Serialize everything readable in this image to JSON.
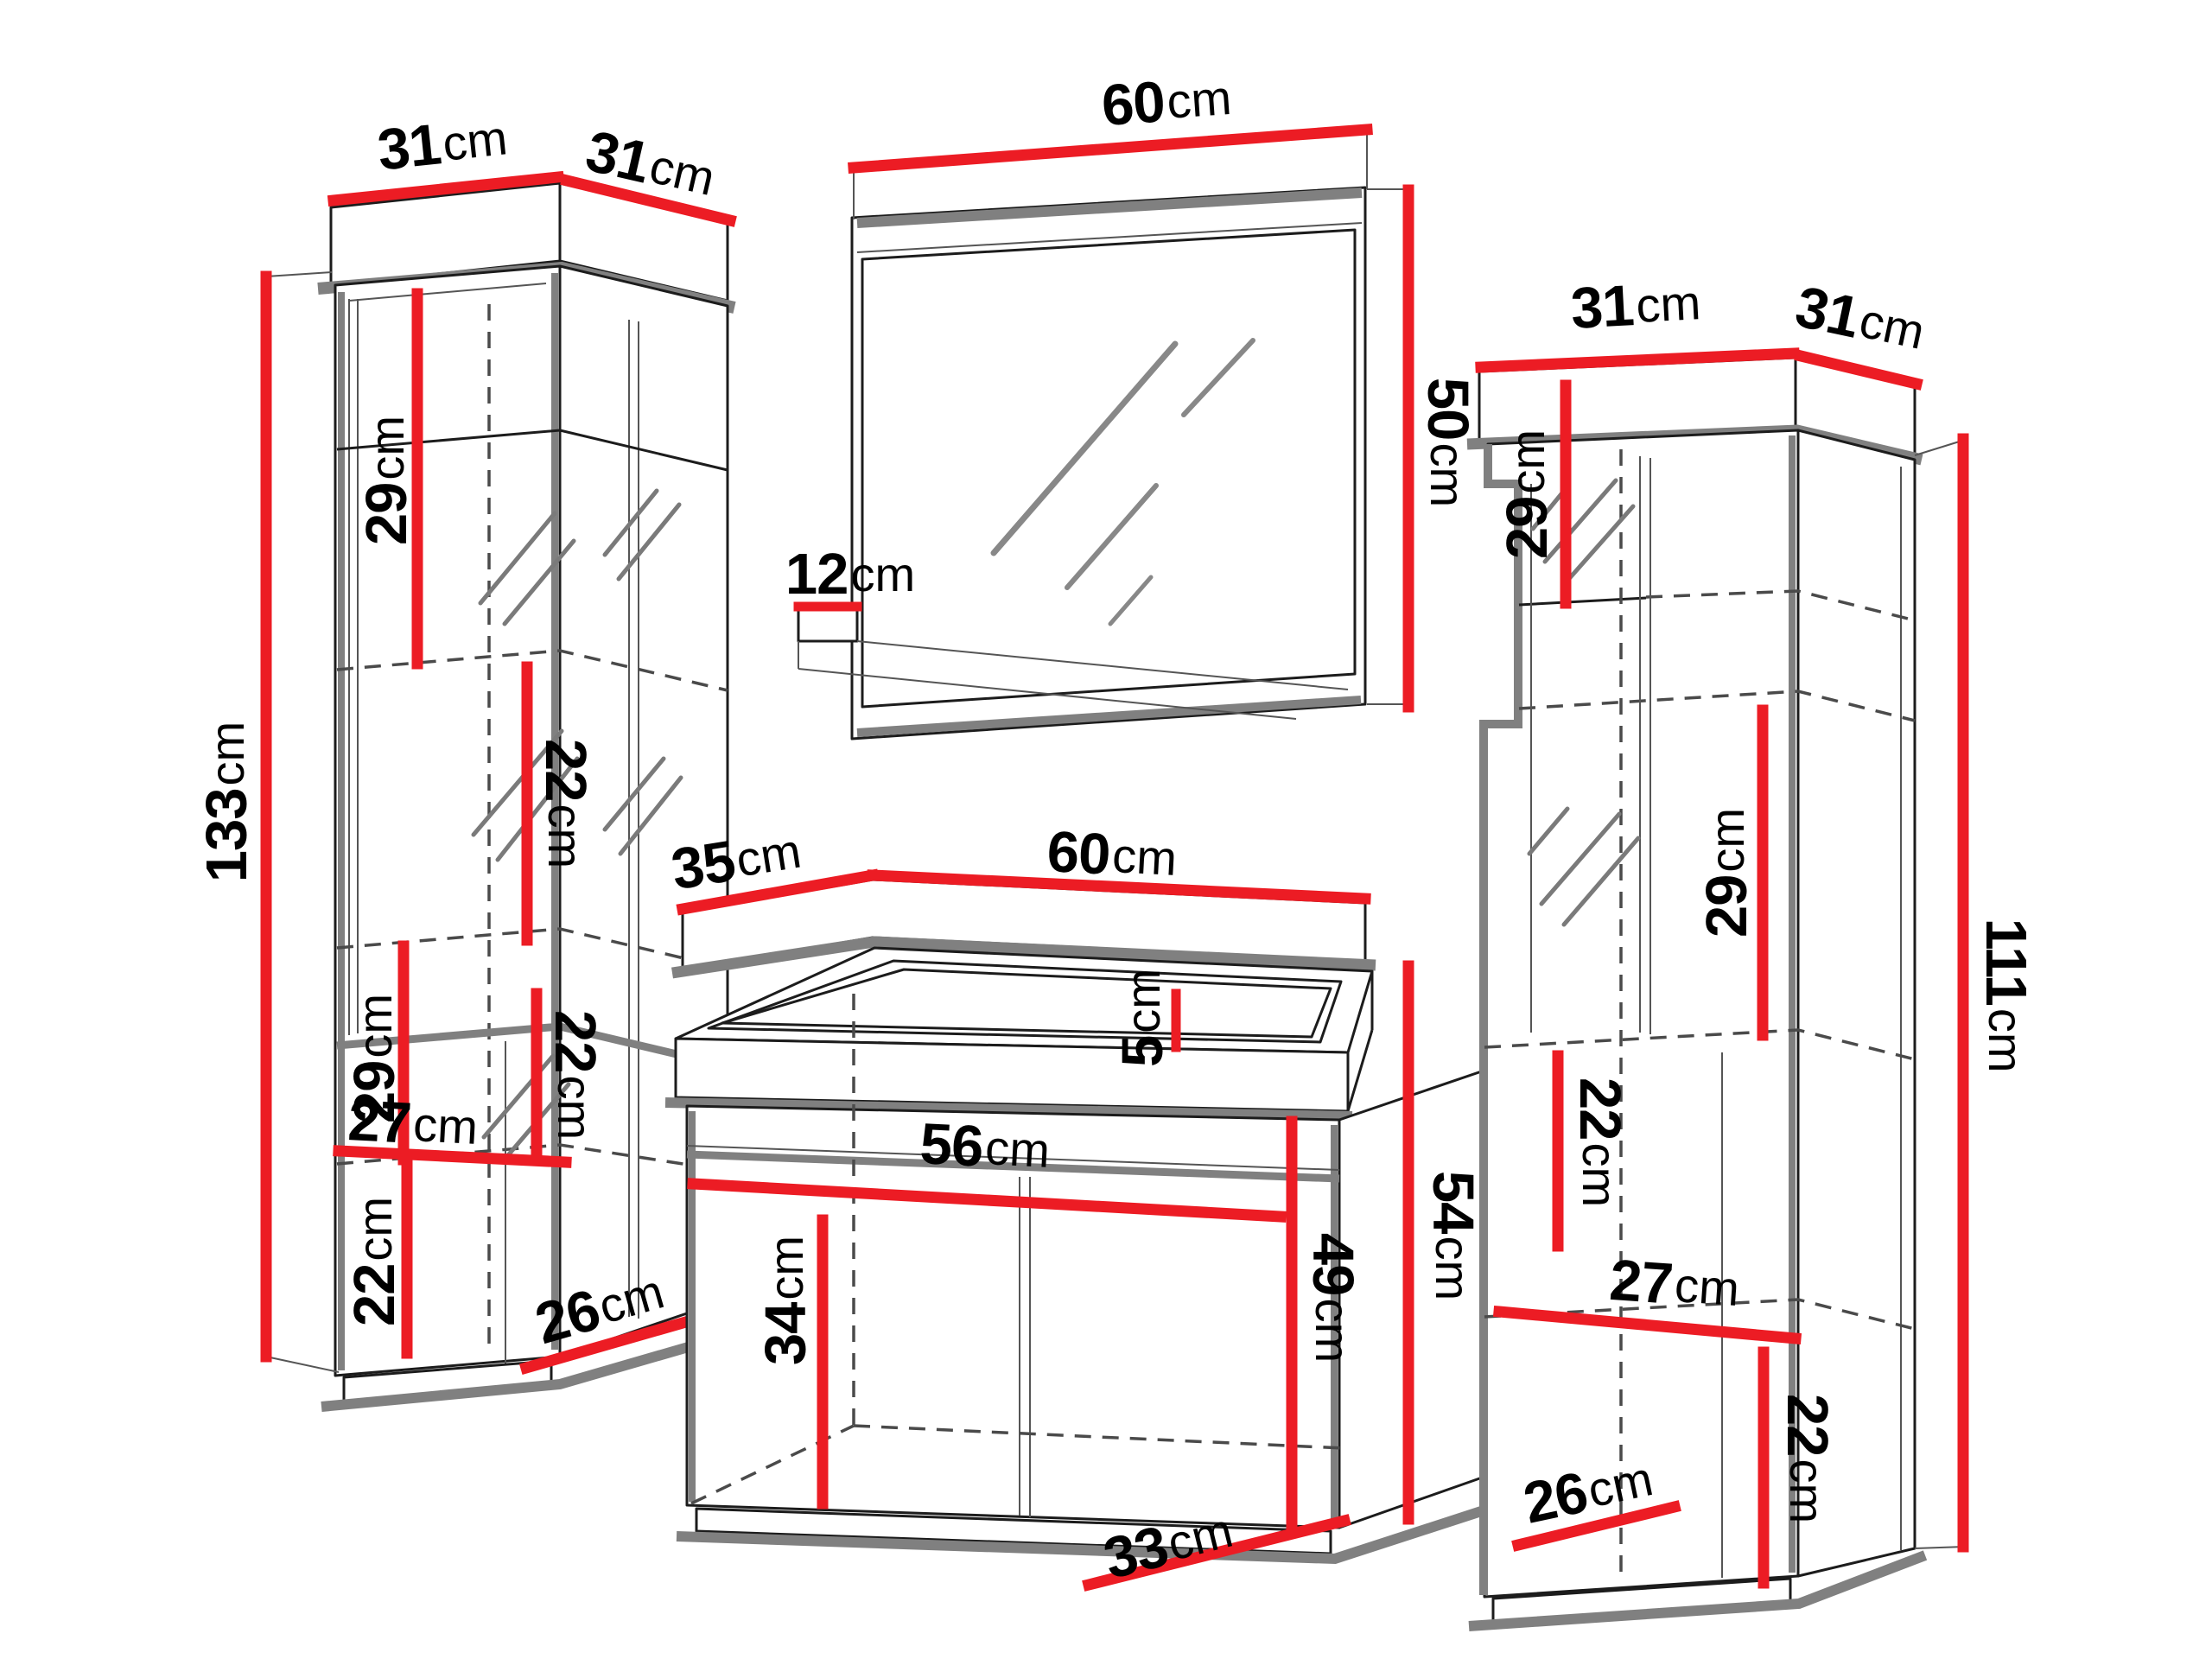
{
  "diagram": {
    "title": "bathroom-furniture-set-dimensions",
    "type": "furniture-dimension-diagram",
    "unit": "cm",
    "accent_color": "#ec1c24",
    "outline_color": "#1c1c1c",
    "shadow_gray": "#808080"
  },
  "left_cabinet": {
    "name": "tall display cabinet (left)",
    "dims": {
      "top_front": {
        "v": "31",
        "u": "cm"
      },
      "top_side": {
        "v": "31",
        "u": "cm"
      },
      "height": {
        "v": "133",
        "u": "cm"
      },
      "upper_shelf_gap": {
        "v": "29",
        "u": "cm"
      },
      "middle_shelf_gap": {
        "v": "22",
        "u": "cm"
      },
      "lower_shelf_gap": {
        "v": "29",
        "u": "cm"
      },
      "bottom_gap_right": {
        "v": "22",
        "u": "cm"
      },
      "bottom_width": {
        "v": "27",
        "u": "cm"
      },
      "bottom_gap_left": {
        "v": "22",
        "u": "cm"
      },
      "base_depth": {
        "v": "26",
        "u": "cm"
      }
    }
  },
  "mirror": {
    "name": "wall mirror",
    "dims": {
      "width": {
        "v": "60",
        "u": "cm"
      },
      "height": {
        "v": "50",
        "u": "cm"
      },
      "shelf_depth": {
        "v": "12",
        "u": "cm"
      }
    }
  },
  "vanity": {
    "name": "sink vanity cabinet",
    "dims": {
      "top_depth": {
        "v": "35",
        "u": "cm"
      },
      "top_width": {
        "v": "60",
        "u": "cm"
      },
      "basin_height": {
        "v": "5",
        "u": "cm"
      },
      "inner_width": {
        "v": "56",
        "u": "cm"
      },
      "door_height": {
        "v": "34",
        "u": "cm"
      },
      "front_height": {
        "v": "49",
        "u": "cm"
      },
      "side_height": {
        "v": "54",
        "u": "cm"
      },
      "base_depth": {
        "v": "33",
        "u": "cm"
      }
    }
  },
  "right_cabinet": {
    "name": "tall cabinet (right)",
    "dims": {
      "top_front": {
        "v": "31",
        "u": "cm"
      },
      "top_side": {
        "v": "31",
        "u": "cm"
      },
      "upper_shelf_gap": {
        "v": "29",
        "u": "cm"
      },
      "middle_shelf_gap": {
        "v": "29",
        "u": "cm"
      },
      "height": {
        "v": "111",
        "u": "cm"
      },
      "bottom_gap_upper": {
        "v": "22",
        "u": "cm"
      },
      "bottom_width": {
        "v": "27",
        "u": "cm"
      },
      "bottom_gap_lower": {
        "v": "22",
        "u": "cm"
      },
      "base_depth": {
        "v": "26",
        "u": "cm"
      }
    }
  }
}
